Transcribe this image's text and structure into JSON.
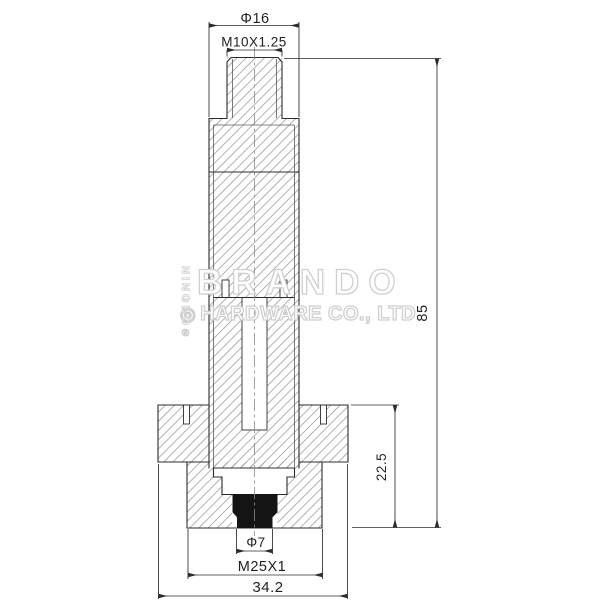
{
  "drawing": {
    "title": "solenoid-armature-cross-section",
    "dimensions": {
      "top_diameter": "Φ16",
      "top_thread": "M10X1.25",
      "overall_height": "85",
      "lower_height": "22.5",
      "seal_diameter": "Φ7",
      "bottom_thread": "M25X1",
      "flange_width": "34.2"
    },
    "watermark": {
      "brand": "BRANDO",
      "company": "HARDWARE CO., LTD",
      "logo_glyph": "◎",
      "side_text": "NINGBO",
      "registered_mark": "®",
      "color": "#cfcfcf"
    },
    "colors": {
      "line": "#2c2c2c",
      "secondary_line": "#5a5a5a",
      "hatch": "#9e9e9e",
      "seal": "#141414",
      "background": "#ffffff"
    }
  }
}
